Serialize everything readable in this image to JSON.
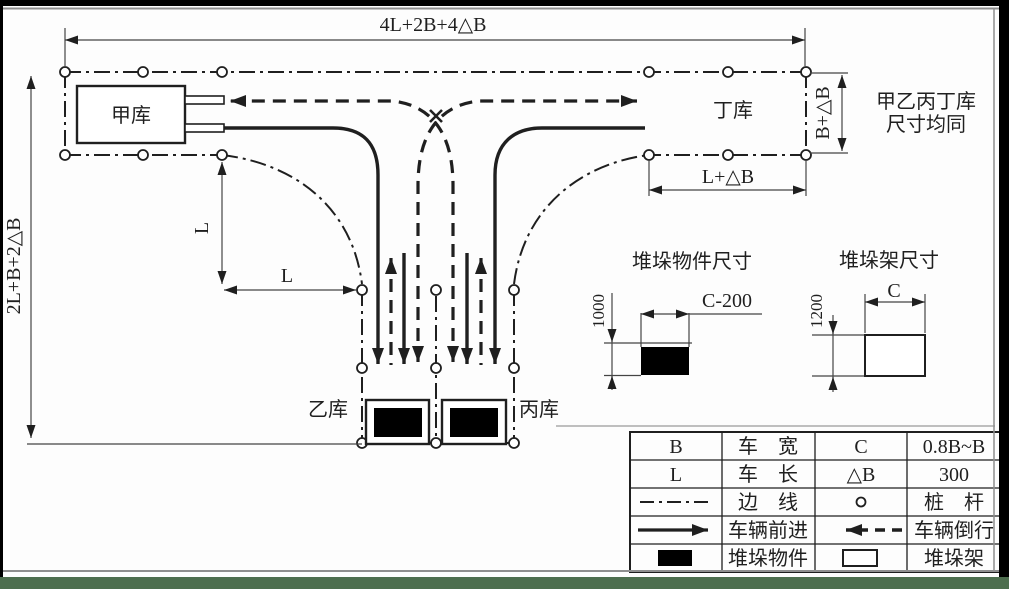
{
  "diagram": {
    "dim_top": "4L+2B+4△B",
    "dim_left": "2L+B+2△B",
    "dim_l_vertical": "L",
    "dim_l_horizontal": "L",
    "dim_l_plus_db": "L+△B",
    "dim_b_plus_db": "B+△B",
    "warehouse_top_left": "甲库",
    "warehouse_top_right": "丁库",
    "warehouse_bottom_left": "乙库",
    "warehouse_bottom_right": "丙库",
    "note_line1": "甲乙丙丁库",
    "note_line2": "尺寸均同"
  },
  "stack_object": {
    "title": "堆垛物件尺寸",
    "height_label": "1000",
    "width_label": "C-200"
  },
  "stack_rack": {
    "title": "堆垛架尺寸",
    "height_label": "1200",
    "width_label": "C"
  },
  "legend_table": {
    "rows": [
      {
        "col1": "B",
        "col2": "车　宽",
        "col3": "C",
        "col4": "0.8B~B"
      },
      {
        "col1": "L",
        "col2": "车　长",
        "col3": "△B",
        "col4": "300"
      },
      {
        "col1_symbol": "boundary-dash-dot-line",
        "col2": "边　线",
        "col3_symbol": "stake-circle",
        "col4": "桩　杆"
      },
      {
        "col1_symbol": "forward-solid-arrow",
        "col2": "车辆前进",
        "col3_symbol": "reverse-dashed-arrow",
        "col4": "车辆倒行"
      },
      {
        "col1_symbol": "stacked-object-filled-rect",
        "col2": "堆垛物件",
        "col3_symbol": "stacking-rack-open-rect",
        "col4": "堆垛架"
      }
    ]
  },
  "colors": {
    "ink": "#1f1f1f",
    "frame_gray": "#8f8f8f",
    "bottom_band_green": "#4d6e4e",
    "band_black": "#000000",
    "paper": "#fdfdfd"
  }
}
